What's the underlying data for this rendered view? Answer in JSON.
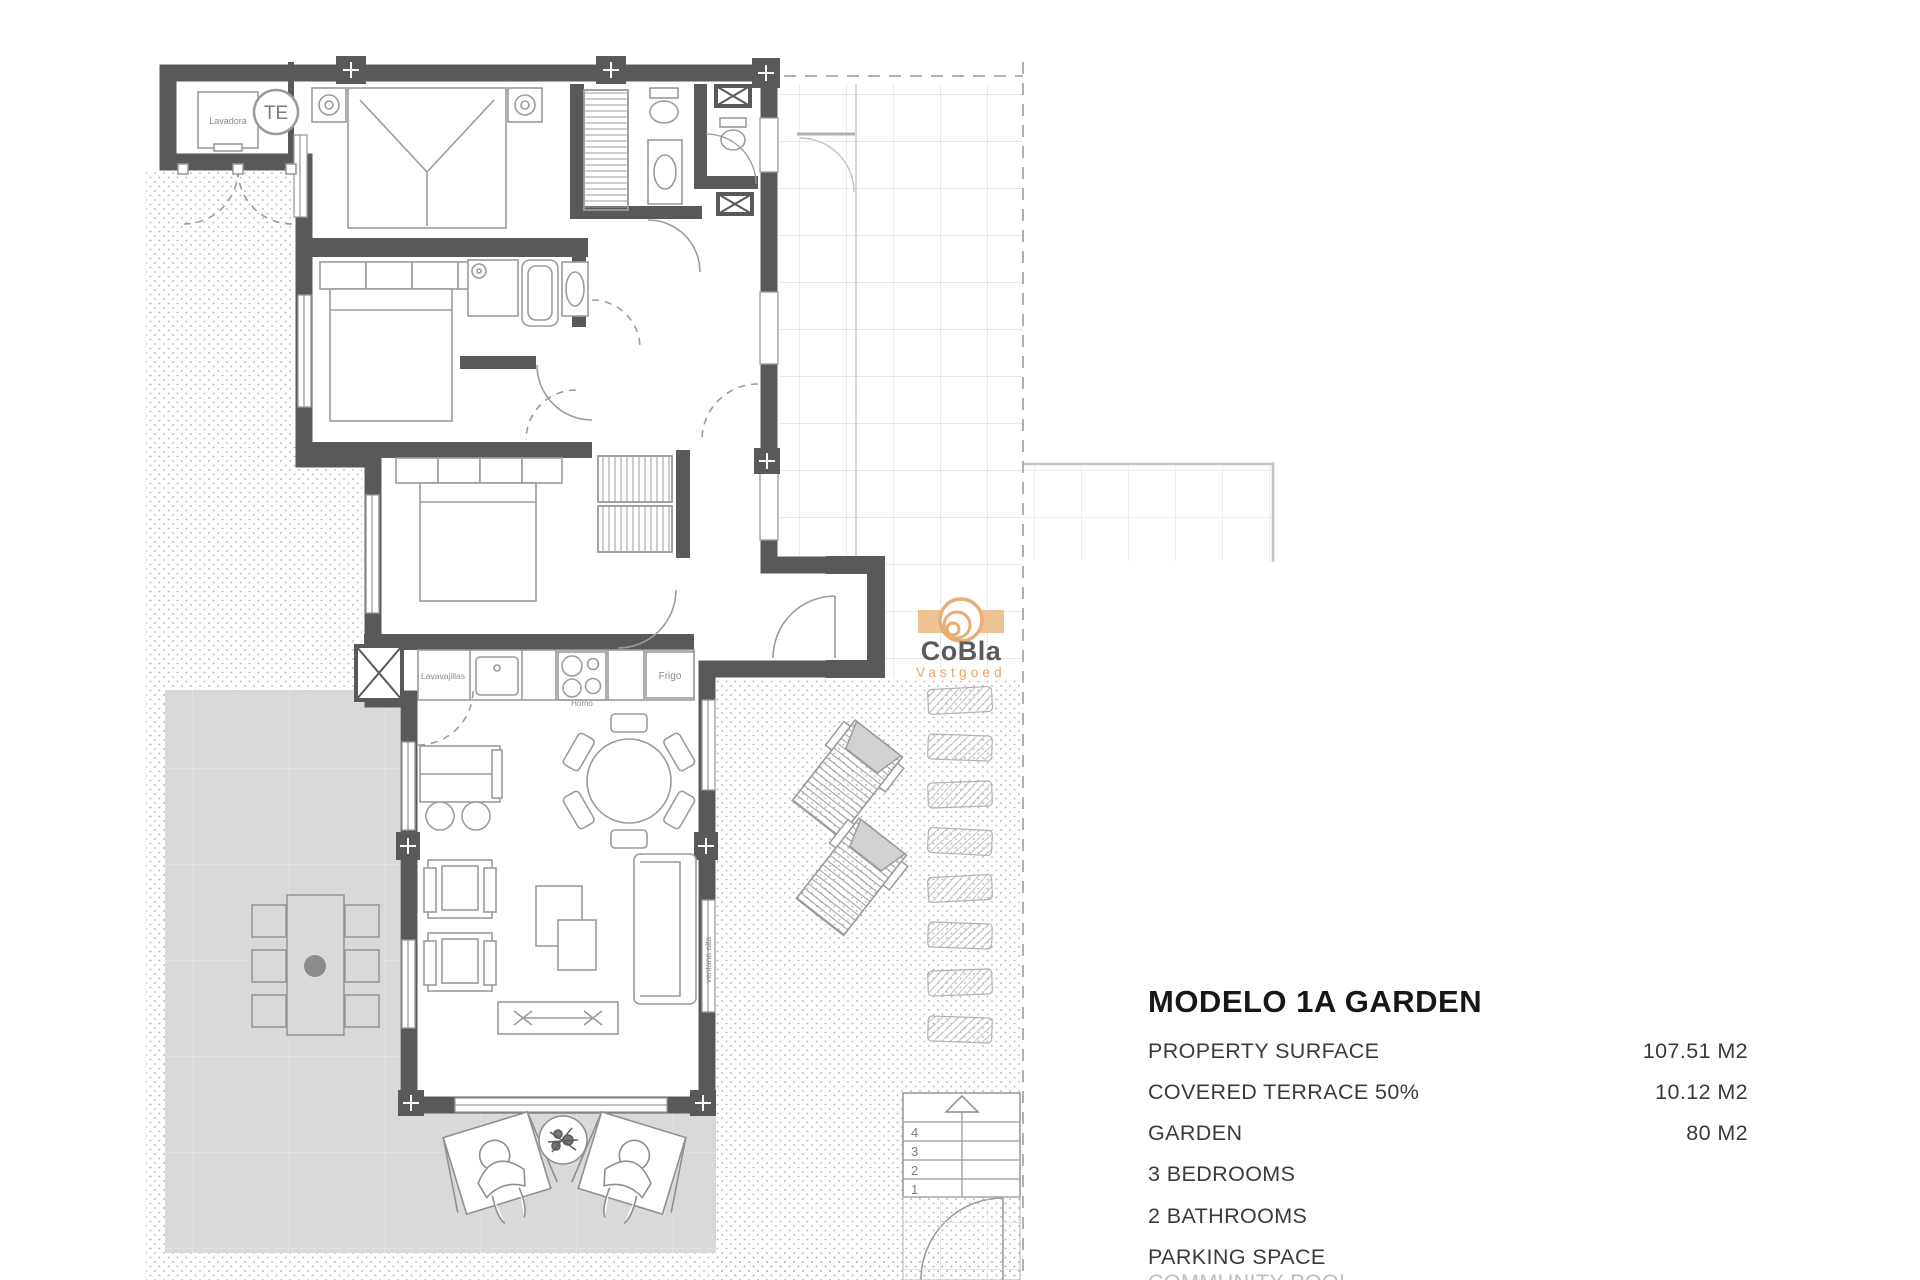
{
  "logo": {
    "name": "CoBla",
    "subtitle": "Vastgoed",
    "accent_orange": "#E7AE74",
    "subtitle_orange": "#E6A663",
    "name_gray": "#5A5B5E"
  },
  "plan": {
    "labels": {
      "washing_machine": "Lavadora",
      "water_heater": "TE",
      "dishwasher": "Lavavajillas",
      "fridge": "Frigo",
      "oven": "Horno",
      "high_window": "ventana alta"
    },
    "stair_step_numbers": [
      "4",
      "3",
      "2",
      "1"
    ],
    "colors": {
      "wall": "#595959",
      "terrace": "#d9d9d9",
      "furniture_line": "#9b9b9b"
    }
  },
  "info": {
    "title": "MODELO 1A GARDEN",
    "rows": [
      {
        "label": "PROPERTY SURFACE",
        "value": "107.51 M2"
      },
      {
        "label": "COVERED TERRACE 50%",
        "value": "10.12 M2"
      },
      {
        "label": "GARDEN",
        "value": "80 M2"
      },
      {
        "label": "3 BEDROOMS",
        "value": ""
      },
      {
        "label": "2 BATHROOMS",
        "value": ""
      },
      {
        "label": "PARKING SPACE",
        "value": ""
      },
      {
        "label": "COMMUNITY POOL",
        "value": ""
      }
    ]
  }
}
